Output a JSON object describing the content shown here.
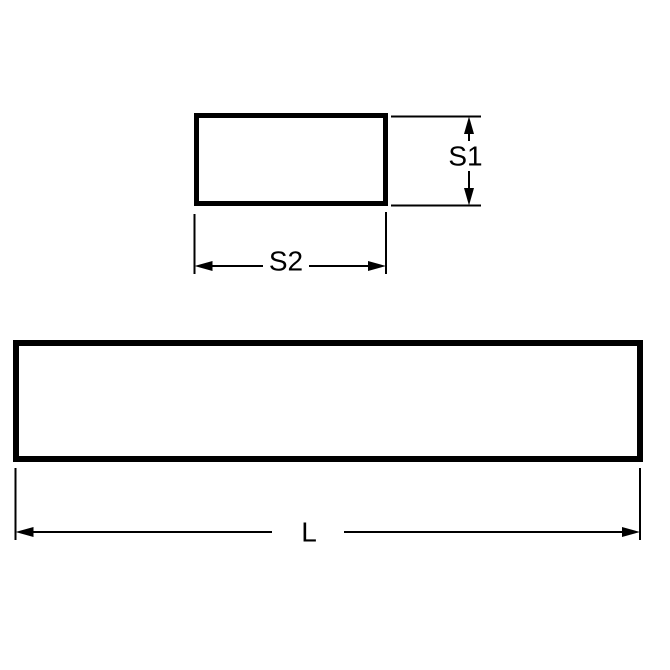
{
  "diagram": {
    "background_color": "#ffffff",
    "line_color": "#000000",
    "cross_section_view": {
      "height_dimension_label": "S1",
      "width_dimension_label": "S2"
    },
    "length_view": {
      "length_dimension_label": "L"
    }
  }
}
